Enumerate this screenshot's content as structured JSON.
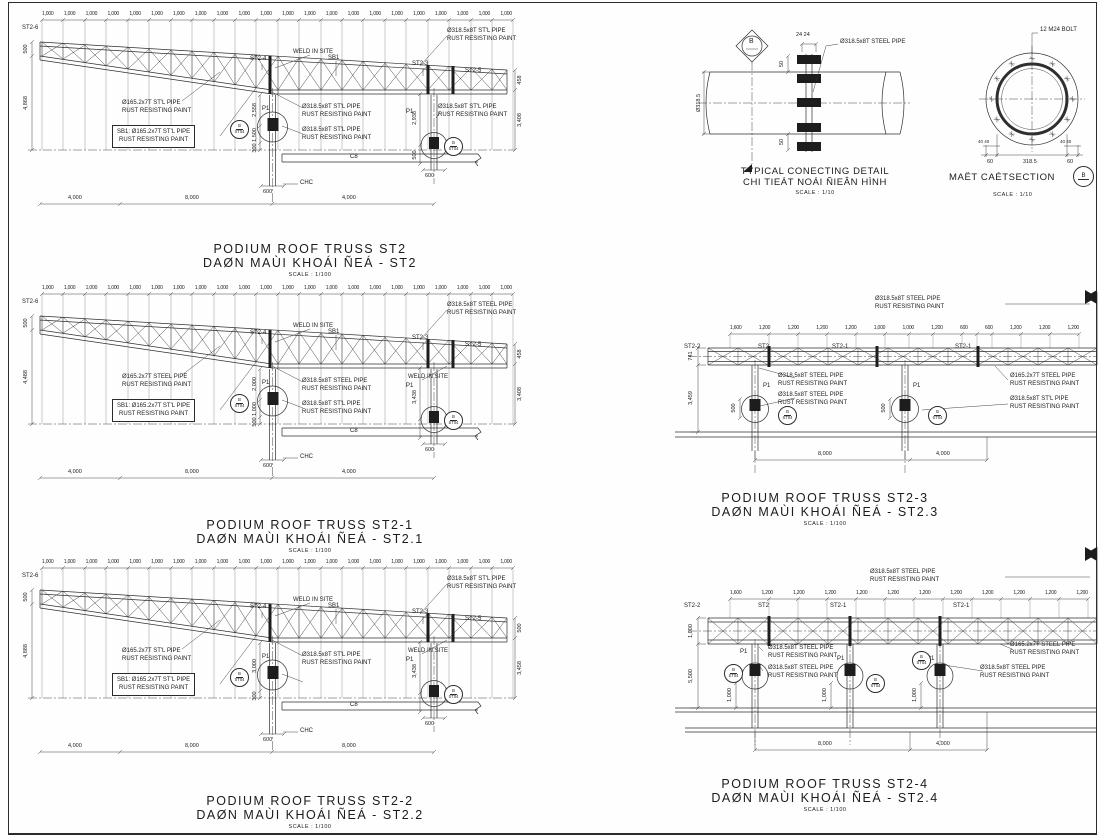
{
  "common": {
    "weld_in_site": "WELD IN SITE",
    "p1": "P1",
    "c8": "C8",
    "chc": "CHC",
    "sb1": "SB1",
    "pipe318_stl": "Ø318.5x8T ST'L PIPE",
    "pipe318_steel": "Ø318.5x8T STEEL PIPE",
    "pipe165_stl": "Ø165.2x7T ST'L PIPE",
    "pipe165_steel": "Ø165.2x7T STEEL PIPE",
    "rust": "RUST RESISTING PAINT",
    "sb1_note": "SB1: Ø165.2x7T ST'L PIPE",
    "scale_100": "SCALE : 1/100",
    "scale_10": "SCALE : 1/10",
    "bubble_top": "B",
    "bubble_bottom": "ST04",
    "section_mark": "B"
  },
  "marks": {
    "st2": "ST2",
    "st2_1": "ST2-1",
    "st2_2": "ST2-2",
    "st2_3": "ST2-3",
    "st2_4": "ST2-4",
    "st2_5": "ST2-5",
    "st2_6": "ST2-6"
  },
  "truss_a": {
    "title_en": "PODIUM ROOF TRUSS ST2",
    "title_vn": "DAØN MAÙI KHOÁI ÑEÁ - ST2",
    "top_dims": [
      "1,000",
      "1,000",
      "1,000",
      "1,000",
      "1,000",
      "1,000",
      "1,000",
      "1,000",
      "1,000",
      "1,000",
      "1,000",
      "1,000",
      "1,000",
      "1,000",
      "1,000",
      "1,000",
      "1,000",
      "1,000",
      "1,000",
      "1,000",
      "1,000",
      "1,000"
    ],
    "bottom_dims": [
      "4,000",
      "8,000",
      "4,000"
    ],
    "col_base_dims": [
      "600",
      "600"
    ],
    "dim_end_depth": "500",
    "dim_height": "4,868",
    "dims_mid": [
      "2,558",
      "1,500",
      "300"
    ],
    "dims_col_right": [
      "2,938",
      "500"
    ],
    "dims_right": [
      "458",
      "3,408"
    ]
  },
  "truss_b": {
    "title_en": "PODIUM ROOF TRUSS ST2-1",
    "title_vn": "DAØN MAÙI KHOÁI ÑEÁ - ST2.1",
    "top_dims": [
      "1,000",
      "1,000",
      "1,000",
      "1,000",
      "1,000",
      "1,000",
      "1,000",
      "1,000",
      "1,000",
      "1,000",
      "1,000",
      "1,000",
      "1,000",
      "1,000",
      "1,000",
      "1,000",
      "1,000",
      "1,000",
      "1,000",
      "1,000",
      "1,000",
      "1,000"
    ],
    "bottom_dims": [
      "4,000",
      "8,000",
      "4,000"
    ],
    "col_base_dims": [
      "600",
      "600"
    ],
    "dim_end_depth": "500",
    "dim_height": "4,488",
    "dims_mid": [
      "2,000",
      "1,000",
      "500"
    ],
    "dims_col_right": [
      "3,438"
    ],
    "dims_right": [
      "458",
      "3,408"
    ]
  },
  "truss_c": {
    "title_en": "PODIUM ROOF TRUSS ST2-2",
    "title_vn": "DAØN MAÙI KHOÁI ÑEÁ - ST2.2",
    "top_dims": [
      "1,000",
      "1,000",
      "1,000",
      "1,000",
      "1,000",
      "1,000",
      "1,000",
      "1,000",
      "1,000",
      "1,000",
      "1,000",
      "1,000",
      "1,000",
      "1,000",
      "1,000",
      "1,000",
      "1,000",
      "1,000",
      "1,000",
      "1,000",
      "1,000",
      "1,000"
    ],
    "bottom_dims": [
      "4,000",
      "8,000",
      "8,000"
    ],
    "col_base_dims": [
      "600",
      "600"
    ],
    "dim_end_depth": "500",
    "dim_height": "4,888",
    "dims_mid": [
      "3,000",
      "300"
    ],
    "dims_col_right": [
      "3,438"
    ],
    "dims_right": [
      "500",
      "3,458"
    ]
  },
  "detail": {
    "title_en": "TYPICAL CONECTING DETAIL",
    "title_vn": "CHI TIEÁT NOÁI ÑIEÂN HÌNH",
    "pipe_label": "Ø318.5x8T STEEL PIPE",
    "dim_plates": "24 24",
    "dim_dia": "Ø318.5",
    "dim_50_top": "50",
    "dim_50_bottom": "50"
  },
  "section": {
    "title": "MAËT CAÉTSECTION",
    "bolt_label": "12 M24 BOLT",
    "dims": [
      "60",
      "318.5",
      "60"
    ],
    "dim_40_left": "40 40",
    "dim_40_right": "40 40"
  },
  "truss_f": {
    "title_en": "PODIUM ROOF TRUSS ST2-3",
    "title_vn": "DAØN MAÙI KHOÁI ÑEÁ - ST2.3",
    "top_dims": [
      "1,600",
      "1,200",
      "1,200",
      "1,200",
      "1,200",
      "1,000",
      "1,000",
      "1,200",
      "600",
      "600",
      "1,200",
      "1,200",
      "1,200"
    ],
    "bottom_dims": [
      "8,000",
      "4,000"
    ],
    "dim_depth": "741",
    "dim_height": "3,459",
    "base_dims": [
      "500",
      "500"
    ]
  },
  "truss_g": {
    "title_en": "PODIUM ROOF TRUSS ST2-4",
    "title_vn": "DAØN MAÙI KHOÁI ÑEÁ - ST2.4",
    "top_dims": [
      "1,600",
      "1,200",
      "1,200",
      "1,200",
      "1,200",
      "1,200",
      "1,200",
      "1,200",
      "1,200",
      "1,200",
      "1,200",
      "1,200"
    ],
    "bottom_dims": [
      "8,000",
      "4,000"
    ],
    "dim_depth": "1,000",
    "dim_height": "5,500",
    "base_dims": [
      "1,000",
      "1,000",
      "1,000"
    ]
  }
}
